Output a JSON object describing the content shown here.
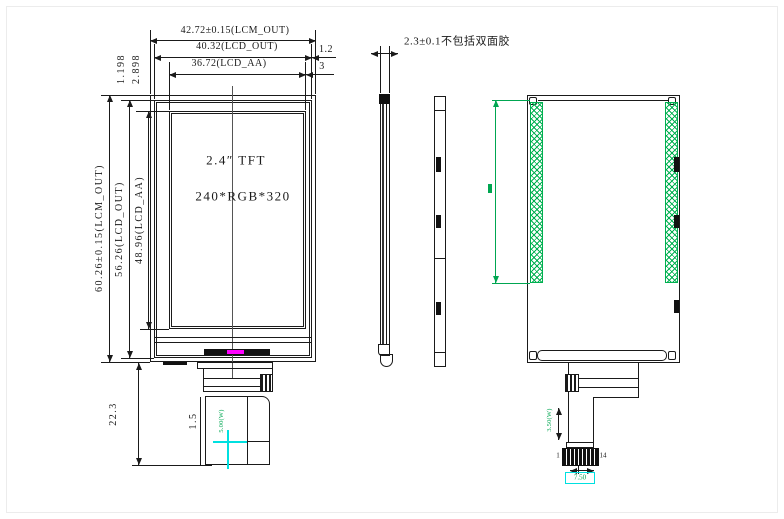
{
  "front": {
    "dims": {
      "width_lcm": "42.72±0.15(LCM_OUT)",
      "width_lcd": "40.32(LCD_OUT)",
      "width_aa": "36.72(LCD_AA)",
      "edge_right_lcd": "1.2",
      "edge_right_aa": "3",
      "edge_top_lcd": "1.198",
      "edge_top_aa": "2.898",
      "height_lcm": "60.26±0.15(LCM_OUT)",
      "height_lcd": "56.26(LCD_OUT)",
      "height_aa": "48.96(LCD_AA)",
      "tail_length": "22.3",
      "tail_edge": "1.5",
      "fpc_width": "5.00(W)"
    },
    "labels": {
      "size": "2.4″ TFT",
      "resolution": "240*RGB*320"
    }
  },
  "side": {
    "dims": {
      "thickness_note": "2.3±0.1不包括双面胶"
    }
  },
  "rear": {
    "dims": {
      "fpc_width": "3.50(W)",
      "connector_width": "7.50"
    },
    "pins": {
      "first": "1",
      "last": "14"
    }
  },
  "colors": {
    "line": "#1a1a1a",
    "tape_green": "#00b050",
    "dim_green": "#00a651",
    "backlight_magenta": "#ff00ff",
    "highlight_cyan": "#00e0e0"
  }
}
